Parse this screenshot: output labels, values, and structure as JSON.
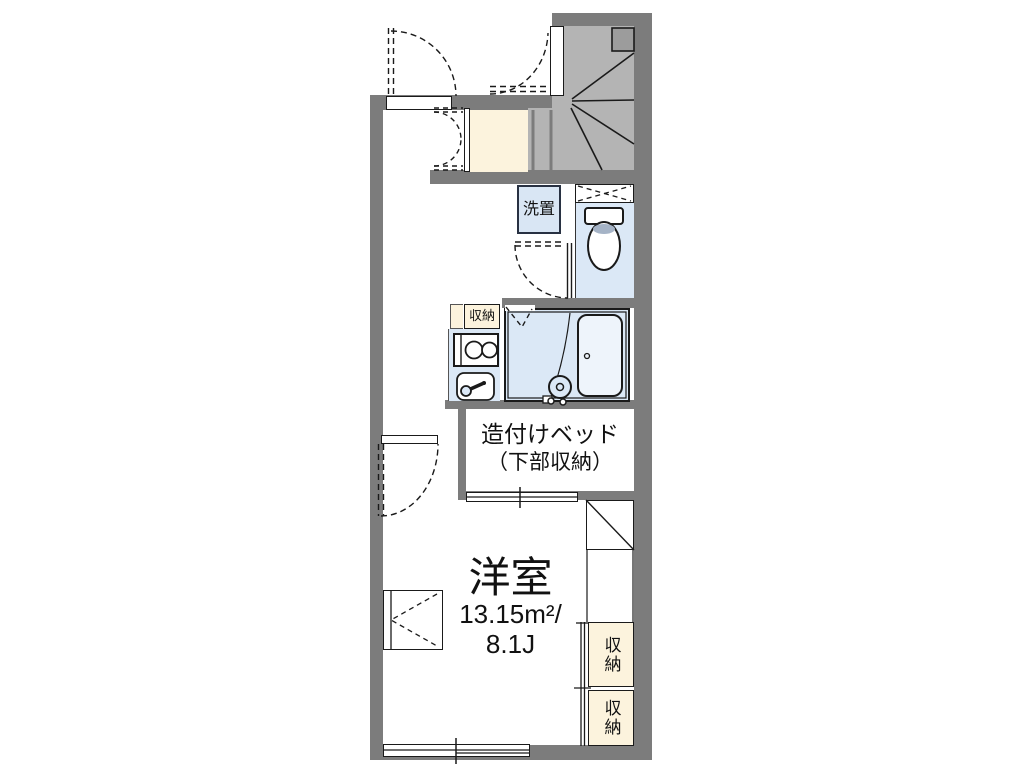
{
  "floorplan": {
    "labels": {
      "laundry": "洗置",
      "kitchen_storage": "収納",
      "built_in_bed_line1": "造付けベッド",
      "built_in_bed_line2": "（下部収納）",
      "room_name": "洋室",
      "room_area": "13.15m²/",
      "room_size_tatami": "8.1J",
      "closet_upper": "収納",
      "closet_lower": "収納"
    },
    "colors": {
      "wall_gray": "#7c7c7c",
      "stair_gray": "#b4b4b4",
      "storage_cream": "#fcf3dd",
      "wet_area_blue": "#dbe8f6",
      "line_black": "#1a1a1a"
    }
  }
}
